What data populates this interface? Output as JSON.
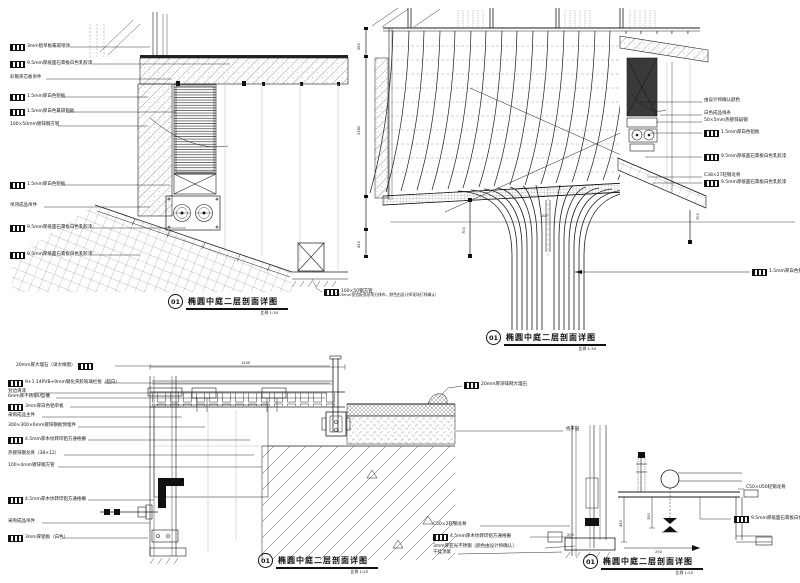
{
  "sheet": {
    "background": "#ffffff",
    "line_color": "#1b1b1b"
  },
  "details": {
    "top_left": {
      "num": "01",
      "title": "椭圆中庭二层剖面详图",
      "scale": "比例 1:30",
      "callouts": [
        {
          "tag": true,
          "text": "3mm铝单板氟碳喷涂"
        },
        {
          "tag": true,
          "text": "9.5mm厚纸面石膏板白色乳胶漆"
        },
        {
          "tag": false,
          "text": "彩钢夹芯板吊件"
        },
        {
          "tag": true,
          "text": "1.5mm厚白色铝板"
        },
        {
          "tag": true,
          "text": "1.5mm厚白色氟碳铝板"
        },
        {
          "tag": false,
          "text": "100×50mm镀锌钢方管"
        },
        {
          "tag": true,
          "text": "1.5mm厚白色铝板"
        },
        {
          "tag": false,
          "text": "吊顶成品吊件"
        },
        {
          "tag": true,
          "text": "9.5mm厚纸面石膏板白色乳胶漆"
        },
        {
          "tag": true,
          "text": "9.5mm厚纸面石膏板白色乳胶漆"
        }
      ],
      "callout_right": {
        "text": "100×50钢方管"
      }
    },
    "top_right": {
      "num": "01",
      "title": "椭圆中庭二层剖面详图",
      "scale": "比例 1:30",
      "callouts": [
        {
          "tag": false,
          "text": "由设计师确认颜色"
        },
        {
          "tag": false,
          "text": "白色成品线条"
        },
        {
          "tag": false,
          "text": "50×5mm热镀锌扁钢"
        },
        {
          "tag": true,
          "text": "1.5mm厚白色铝板"
        },
        {
          "tag": true,
          "text": "9.5mm厚纸面石膏板白色乳胶漆"
        },
        {
          "tag": false,
          "text": "C38×27轻钢龙骨"
        },
        {
          "tag": true,
          "text": "9.5mm厚纸面石膏板白色乳胶漆"
        }
      ],
      "callout_trumpet": {
        "text": "1.5mm厚白色铝板"
      },
      "note": "（100mm宽铝板弧形等分排布，颜色由设计师现场打样确认）",
      "dims": {
        "left_top": "280",
        "left_mid": "2380",
        "left_bot": "450",
        "flare_left": "700",
        "flare_right": "700",
        "center": "100"
      }
    },
    "bottom_left": {
      "num": "01",
      "title": "椭圆中庭二层剖面详图",
      "scale": "比例 1:25",
      "callouts": [
        {
          "tag": true,
          "text": "20mm厚大理石（详大样图）"
        },
        {
          "tag": true,
          "text": "9+1.14PVB+9mm钢化夹胶玻璃栏板（超白）"
        },
        {
          "tag": false,
          "text": "封边清漆"
        },
        {
          "tag": false,
          "text": "6mm厚不锈钢U型槽"
        },
        {
          "tag": true,
          "text": "3mm厚白色铝单板"
        },
        {
          "tag": false,
          "text": "采购成品主件"
        },
        {
          "tag": false,
          "text": "300×300×6mm镀锌钢板预埋件"
        },
        {
          "tag": true,
          "text": "4.5mm厚木纹转印铝方通格栅"
        },
        {
          "tag": false,
          "text": "热镀锌钢龙骨（38×12）"
        },
        {
          "tag": false,
          "text": "100×4mm镀锌钢方管"
        },
        {
          "tag": true,
          "text": "4.5mm厚木纹转印铝方通格栅"
        },
        {
          "tag": false,
          "text": "采购成品吊件"
        },
        {
          "tag": true,
          "text": "3mm厚铝板（白色）"
        }
      ],
      "callout_stone": {
        "text": "20mm厚深啡网大理石"
      },
      "callout_leveling": {
        "text": "找平层"
      },
      "dims": {
        "top": "1500"
      }
    },
    "bottom_right": {
      "num": "01",
      "title": "椭圆中庭二层剖面详图",
      "scale": "比例 1:25",
      "callouts_mid": [
        {
          "tag": false,
          "text": "C50×2轻钢龙骨"
        },
        {
          "tag": true,
          "text": "4.5mm厚木纹转印铝方通格栅"
        },
        {
          "tag": false,
          "text": "3mm厚亚光不锈钢（颜色由设计师确认）"
        },
        {
          "tag": false,
          "text": "干挂顶紧"
        }
      ],
      "callouts_right": [
        {
          "tag": false,
          "text": "C50×U50轻钢龙骨"
        },
        {
          "tag": true,
          "text": "9.5mm厚纸面石膏板白色乳胶漆"
        }
      ],
      "dims": {
        "v1": "450",
        "v2": "350",
        "h1": "250",
        "h2": "200"
      }
    }
  }
}
